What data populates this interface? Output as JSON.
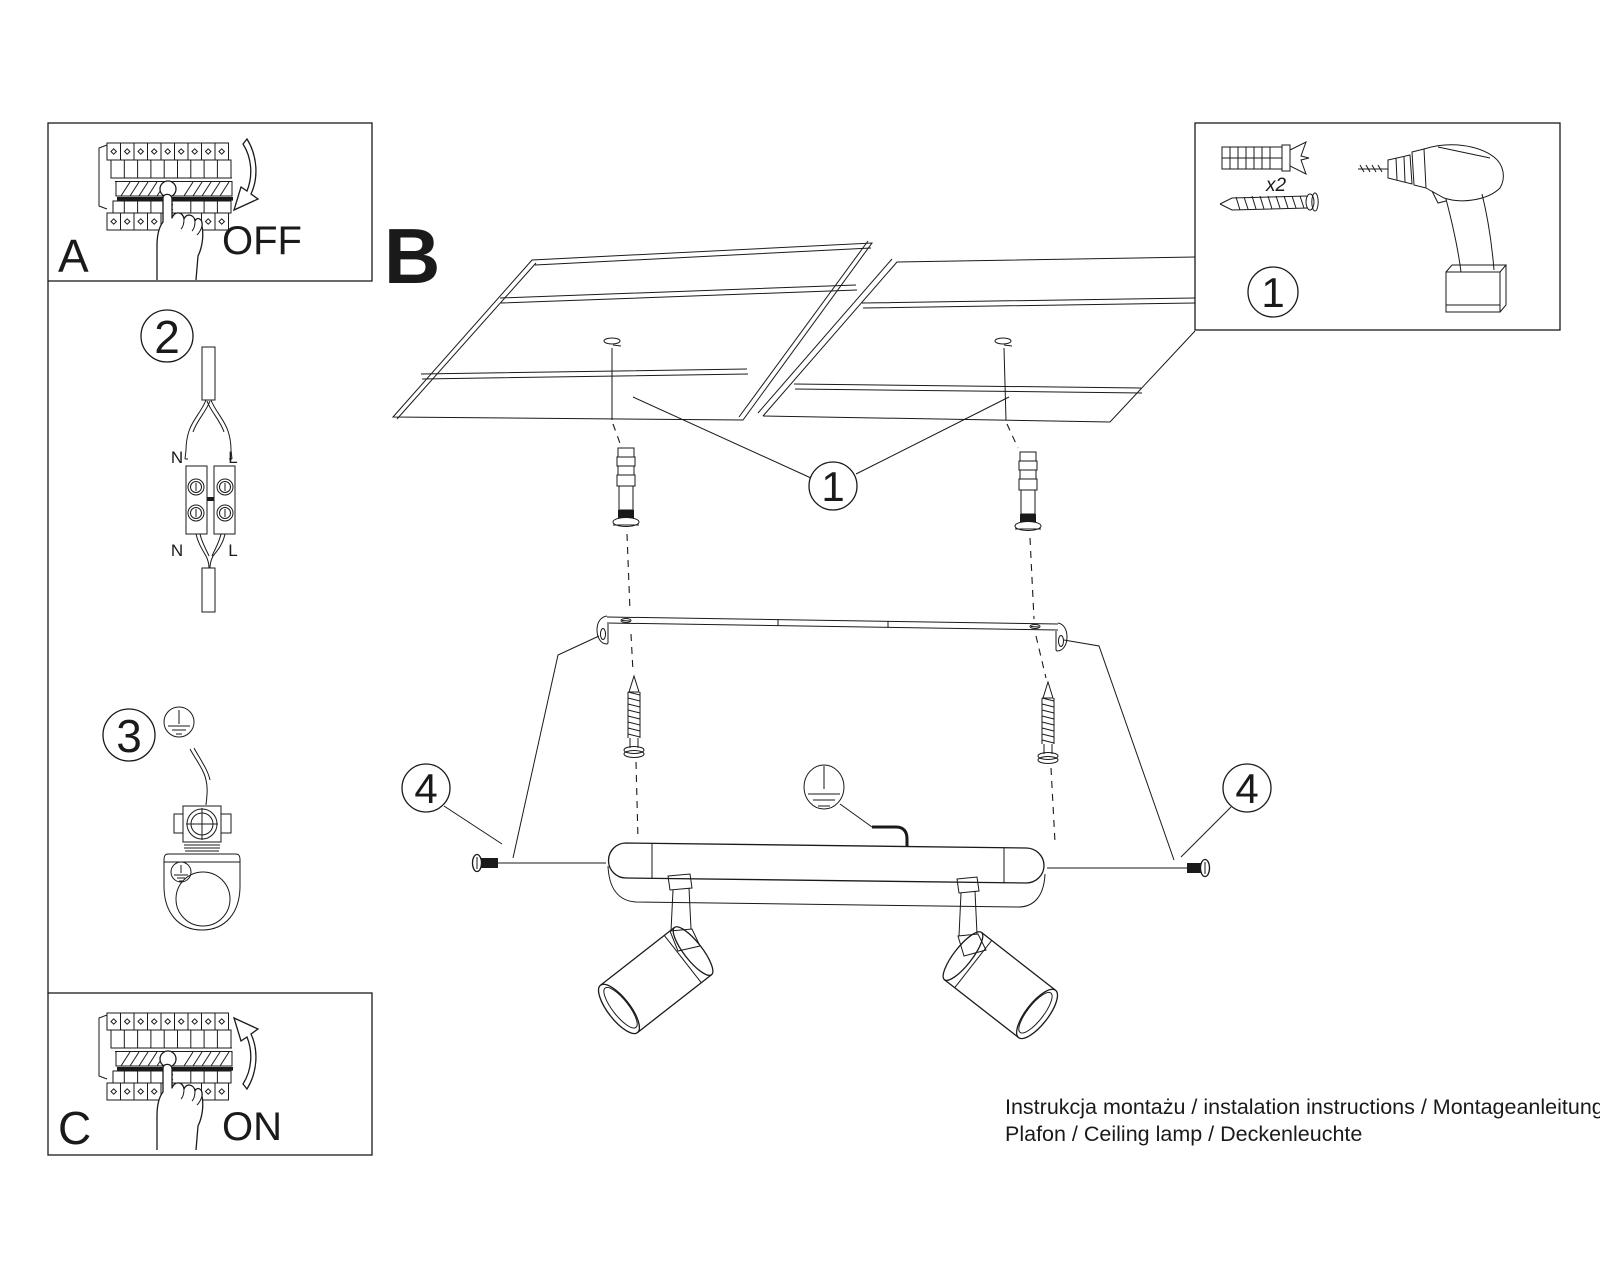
{
  "doc": {
    "background": "#ffffff",
    "ink": "#1a1a1a",
    "steps": {
      "a": {
        "label": "A",
        "action": "OFF"
      },
      "b": {
        "label": "B"
      },
      "c": {
        "label": "C",
        "action": "ON"
      }
    },
    "callouts": {
      "n1": "1",
      "n2": "2",
      "n3": "3",
      "n4": "4"
    },
    "parts": {
      "callout": "1",
      "dowel_qty": "x2"
    },
    "wiring": {
      "top_n": "N",
      "top_l": "L",
      "bottom_n": "N",
      "bottom_l": "L"
    },
    "footer": {
      "line1": "Instrukcja montażu / instalation instructions / Montageanleitung",
      "line2": "Plafon / Ceiling lamp / Deckenleuchte"
    }
  }
}
